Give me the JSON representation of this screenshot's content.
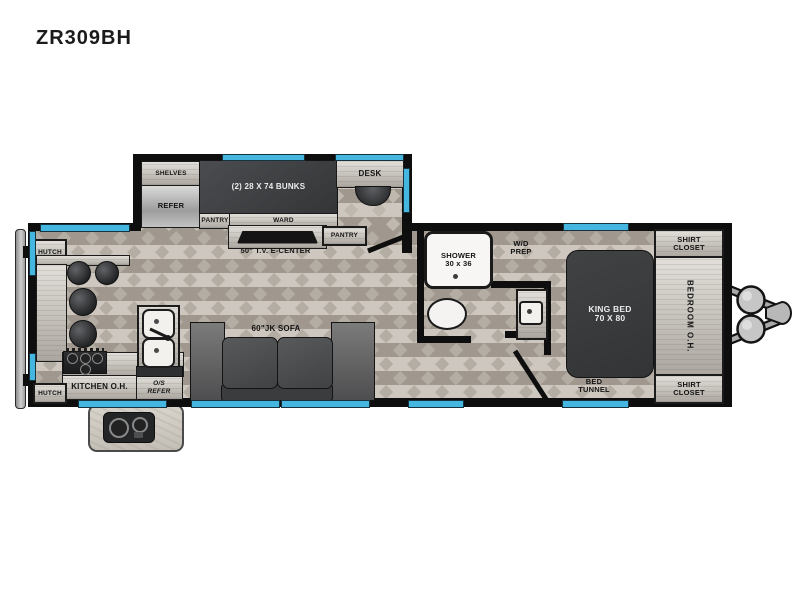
{
  "title": "ZR309BH",
  "colors": {
    "window_accent": "#45b6e0",
    "wall": "#0e0e0e",
    "dark_furniture": "#3a3c3e"
  },
  "slide_out": {
    "shelves_label": "SHELVES",
    "refer_label": "REFER",
    "bunks_label": "(2) 28 X 74 BUNKS",
    "pantry_label": "PANTRY",
    "ward_label": "WARD",
    "desk_label": "DESK"
  },
  "living_area": {
    "tv_center_label": "50\" T.V. E-CENTER",
    "pantry_label": "PANTRY",
    "sofa_label": "60\"JK SOFA"
  },
  "kitchen": {
    "hutch_top_label": "HUTCH",
    "hutch_bottom_label": "HUTCH",
    "kitchen_oh_label": "KITCHEN O.H.",
    "os_refer": {
      "line1": "O/S",
      "line2": "REFER"
    }
  },
  "bathroom": {
    "shower": {
      "line1": "SHOWER",
      "line2": "30 x 36"
    },
    "wd_prep": {
      "line1": "W/D",
      "line2": "PREP"
    }
  },
  "bedroom": {
    "king_bed": {
      "line1": "KING BED",
      "line2": "70 X 80"
    },
    "bedroom_oh_label": "BEDROOM O.H.",
    "shirt_closet_top": {
      "line1": "SHIRT",
      "line2": "CLOSET"
    },
    "shirt_closet_bottom": {
      "line1": "SHIRT",
      "line2": "CLOSET"
    },
    "bed_tunnel": {
      "line1": "BED",
      "line2": "TUNNEL"
    }
  }
}
